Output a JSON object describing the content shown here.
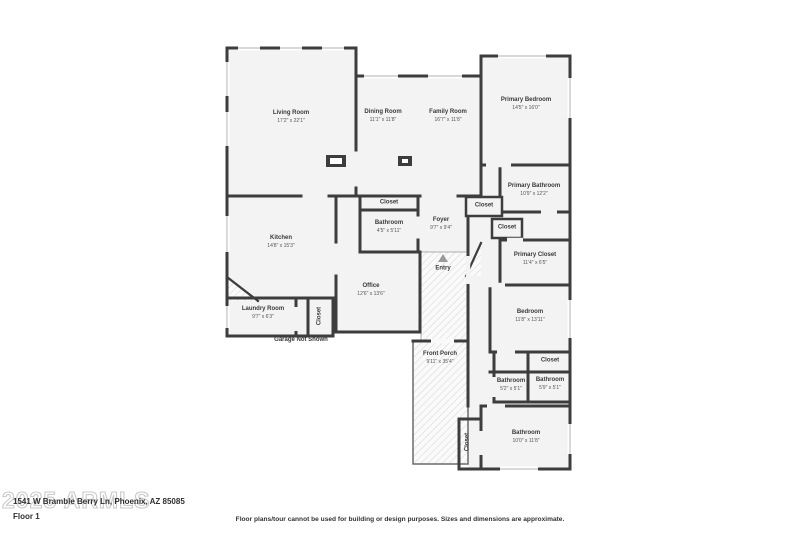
{
  "watermark": "2025 ARMLS",
  "footer": {
    "address": "1541 W Bramble Berry Ln, Phoenix, AZ 85085",
    "floor_label": "Floor 1",
    "disclaimer": "Floor plans/tour cannot be used for building or design purposes. Sizes and dimensions are approximate."
  },
  "garage_note": "Garage Not Shown",
  "entry": {
    "name": "Entry",
    "arrow_icon": "triangle-up"
  },
  "rooms": {
    "living_room": {
      "name": "Living Room",
      "dims": "17'2\" x 22'1\""
    },
    "dining_room": {
      "name": "Dining Room",
      "dims": "11'1\" x 11'8\""
    },
    "family_room": {
      "name": "Family Room",
      "dims": "16'7\" x 11'8\""
    },
    "primary_bedroom": {
      "name": "Primary Bedroom",
      "dims": "14'5\" x 16'0\""
    },
    "primary_bathroom": {
      "name": "Primary Bathroom",
      "dims": "10'9\" x 12'2\""
    },
    "primary_closet": {
      "name": "Primary Closet",
      "dims": "11'4\" x 6'5\""
    },
    "closet_hall_a": {
      "name": "Closet"
    },
    "closet_hall_b": {
      "name": "Closet"
    },
    "closet_bath": {
      "name": "Closet"
    },
    "kitchen": {
      "name": "Kitchen",
      "dims": "14'8\" x 15'3\""
    },
    "bathroom_hall": {
      "name": "Bathroom",
      "dims": "4'5\" x 5'11\""
    },
    "foyer": {
      "name": "Foyer",
      "dims": "9'7\" x 9'4\""
    },
    "office": {
      "name": "Office",
      "dims": "12'6\" x 13'6\""
    },
    "laundry_room": {
      "name": "Laundry Room",
      "dims": "9'7\" x 6'3\""
    },
    "closet_laundry": {
      "name": "Closet"
    },
    "front_porch": {
      "name": "Front Porch",
      "dims": "9'11\" x 35'4\""
    },
    "bedroom": {
      "name": "Bedroom",
      "dims": "11'8\" x 13'11\""
    },
    "closet_bedroom": {
      "name": "Closet"
    },
    "bathroom_left": {
      "name": "Bathroom",
      "dims": "5'2\" x 5'1\""
    },
    "bathroom_right": {
      "name": "Bathroom",
      "dims": "5'9\" x 5'1\""
    },
    "bathroom_bottom": {
      "name": "Bathroom",
      "dims": "10'0\" x 11'8\""
    },
    "closet_bottom": {
      "name": "Closet"
    }
  },
  "colors": {
    "wall": "#3d3d3d",
    "room_fill": "#f3f3f3",
    "hatch": "#d4d4d4",
    "window": "#c0c0c0"
  }
}
